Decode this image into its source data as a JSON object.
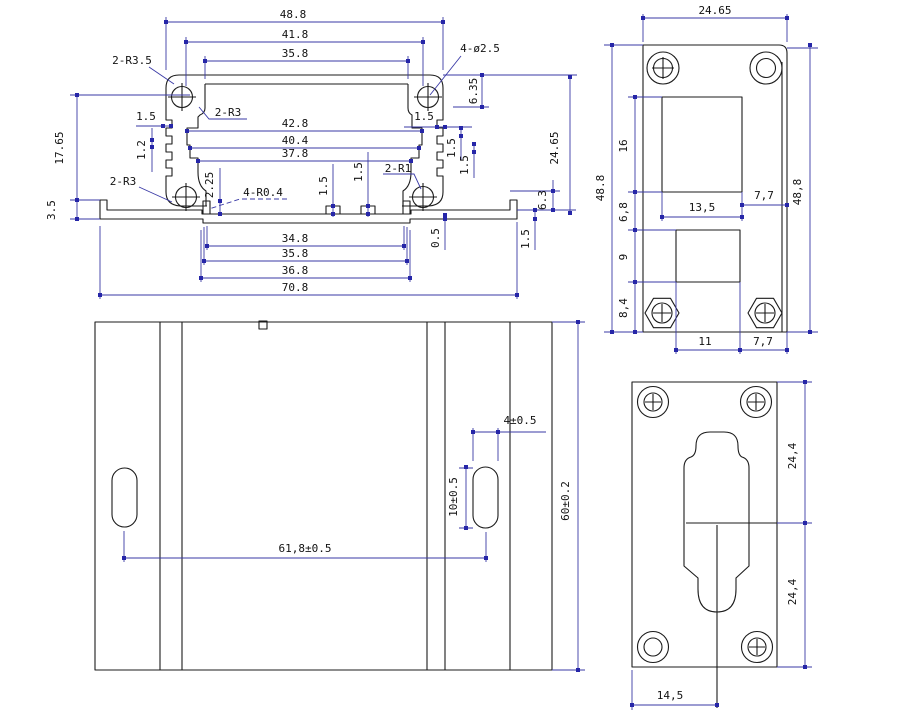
{
  "drawing": {
    "colors": {
      "outline": "#1b1b1b",
      "dimension": "#3a3aa6",
      "background": "#ffffff"
    },
    "section": {
      "top_width": "48.8",
      "mid_width": "41.8",
      "inner_top_width": "35.8",
      "holes_label": "4-ø2.5",
      "corner_r_label": "2-R3.5",
      "upper_r_label": "2-R3",
      "fin_left": "1.5",
      "fin_left_pitch": "1.2",
      "depth_right": "6.35",
      "groove_w1": "42.8",
      "groove_w2": "40.4",
      "inner_width": "37.8",
      "fin_right": "1.5",
      "fin_right_p1": "1.5",
      "fin_right_p2": "1.5",
      "overall_height": "24.65",
      "tab_height": "2.25",
      "clip_label": "4-R0.4",
      "rib_h1": "1.5",
      "rib_h2": "1.5",
      "rib_r_label": "2-R1",
      "lower_r_label": "2-R3",
      "left_height": "17.65",
      "lip_height": "3.5",
      "right_step": "6.3",
      "step": "0.5",
      "plate_thk": "1.5",
      "bot_w1": "34.8",
      "bot_w2": "35.8",
      "bot_w3": "36.8",
      "overall_width": "70.8"
    },
    "rear_plate": {
      "width": "24.65",
      "h_left": "48.8",
      "h_right": "48,8",
      "cut1_h": "16",
      "gap": "6,8",
      "cut2_h": "9",
      "margin_b": "8,4",
      "cut1_w": "13,5",
      "margin_r": "7,7",
      "cut2_w": "11",
      "margin_rb": "7,7"
    },
    "top_view": {
      "slot_w": "4±0.5",
      "slot_h": "10±0.5",
      "slot_dist": "61,8±0.5",
      "body_h": "60±0.2"
    },
    "front_plate": {
      "upper": "24,4",
      "lower": "24,4",
      "offset": "14,5"
    }
  }
}
